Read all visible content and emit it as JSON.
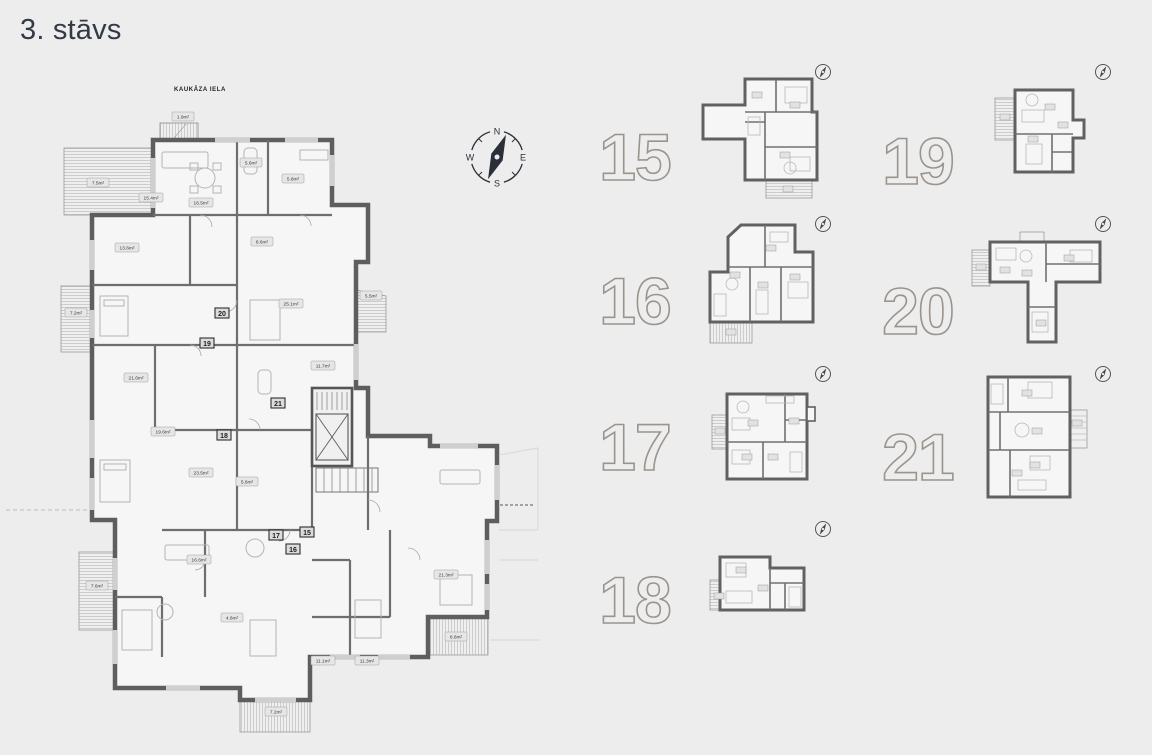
{
  "page": {
    "title": "3. stāvs"
  },
  "colors": {
    "background": "#ededee",
    "wall": "#5e5e5e",
    "number_outline": "#9b948c",
    "title_text": "#333a46",
    "compass": "#2b3038",
    "label_box": "#e6e6e6"
  },
  "main_plan": {
    "street_label": "KAUKĀZA IELA",
    "compass": {
      "north": "N",
      "east": "E",
      "south": "S",
      "west": "W"
    },
    "badges": [
      {
        "num": "20"
      },
      {
        "num": "19"
      },
      {
        "num": "21"
      },
      {
        "num": "18"
      },
      {
        "num": "17"
      },
      {
        "num": "15"
      },
      {
        "num": "16"
      }
    ],
    "area_labels": [
      {
        "text": "1.9m²"
      },
      {
        "text": "7.5m²"
      },
      {
        "text": "15.4m²"
      },
      {
        "text": "16.5m²"
      },
      {
        "text": "5.6m²"
      },
      {
        "text": "5.8m²"
      },
      {
        "text": "13.6m²"
      },
      {
        "text": "7.2m²"
      },
      {
        "text": "21.6m²"
      },
      {
        "text": "25.1m²"
      },
      {
        "text": "11.7m²"
      },
      {
        "text": "5.5m²"
      },
      {
        "text": "8.6m²"
      },
      {
        "text": "19.6m²"
      },
      {
        "text": "23.5m²"
      },
      {
        "text": "5.6m²"
      },
      {
        "text": "16.6m²"
      },
      {
        "text": "7.6m²"
      },
      {
        "text": "11.1m²"
      },
      {
        "text": "11.3m²"
      },
      {
        "text": "7.2m²"
      },
      {
        "text": "21.3m²"
      },
      {
        "text": "8.6m²"
      },
      {
        "text": "4.6m²"
      }
    ]
  },
  "units": [
    {
      "label": "15"
    },
    {
      "label": "19"
    },
    {
      "label": "16"
    },
    {
      "label": "20"
    },
    {
      "label": "17"
    },
    {
      "label": "21"
    },
    {
      "label": "18"
    }
  ]
}
